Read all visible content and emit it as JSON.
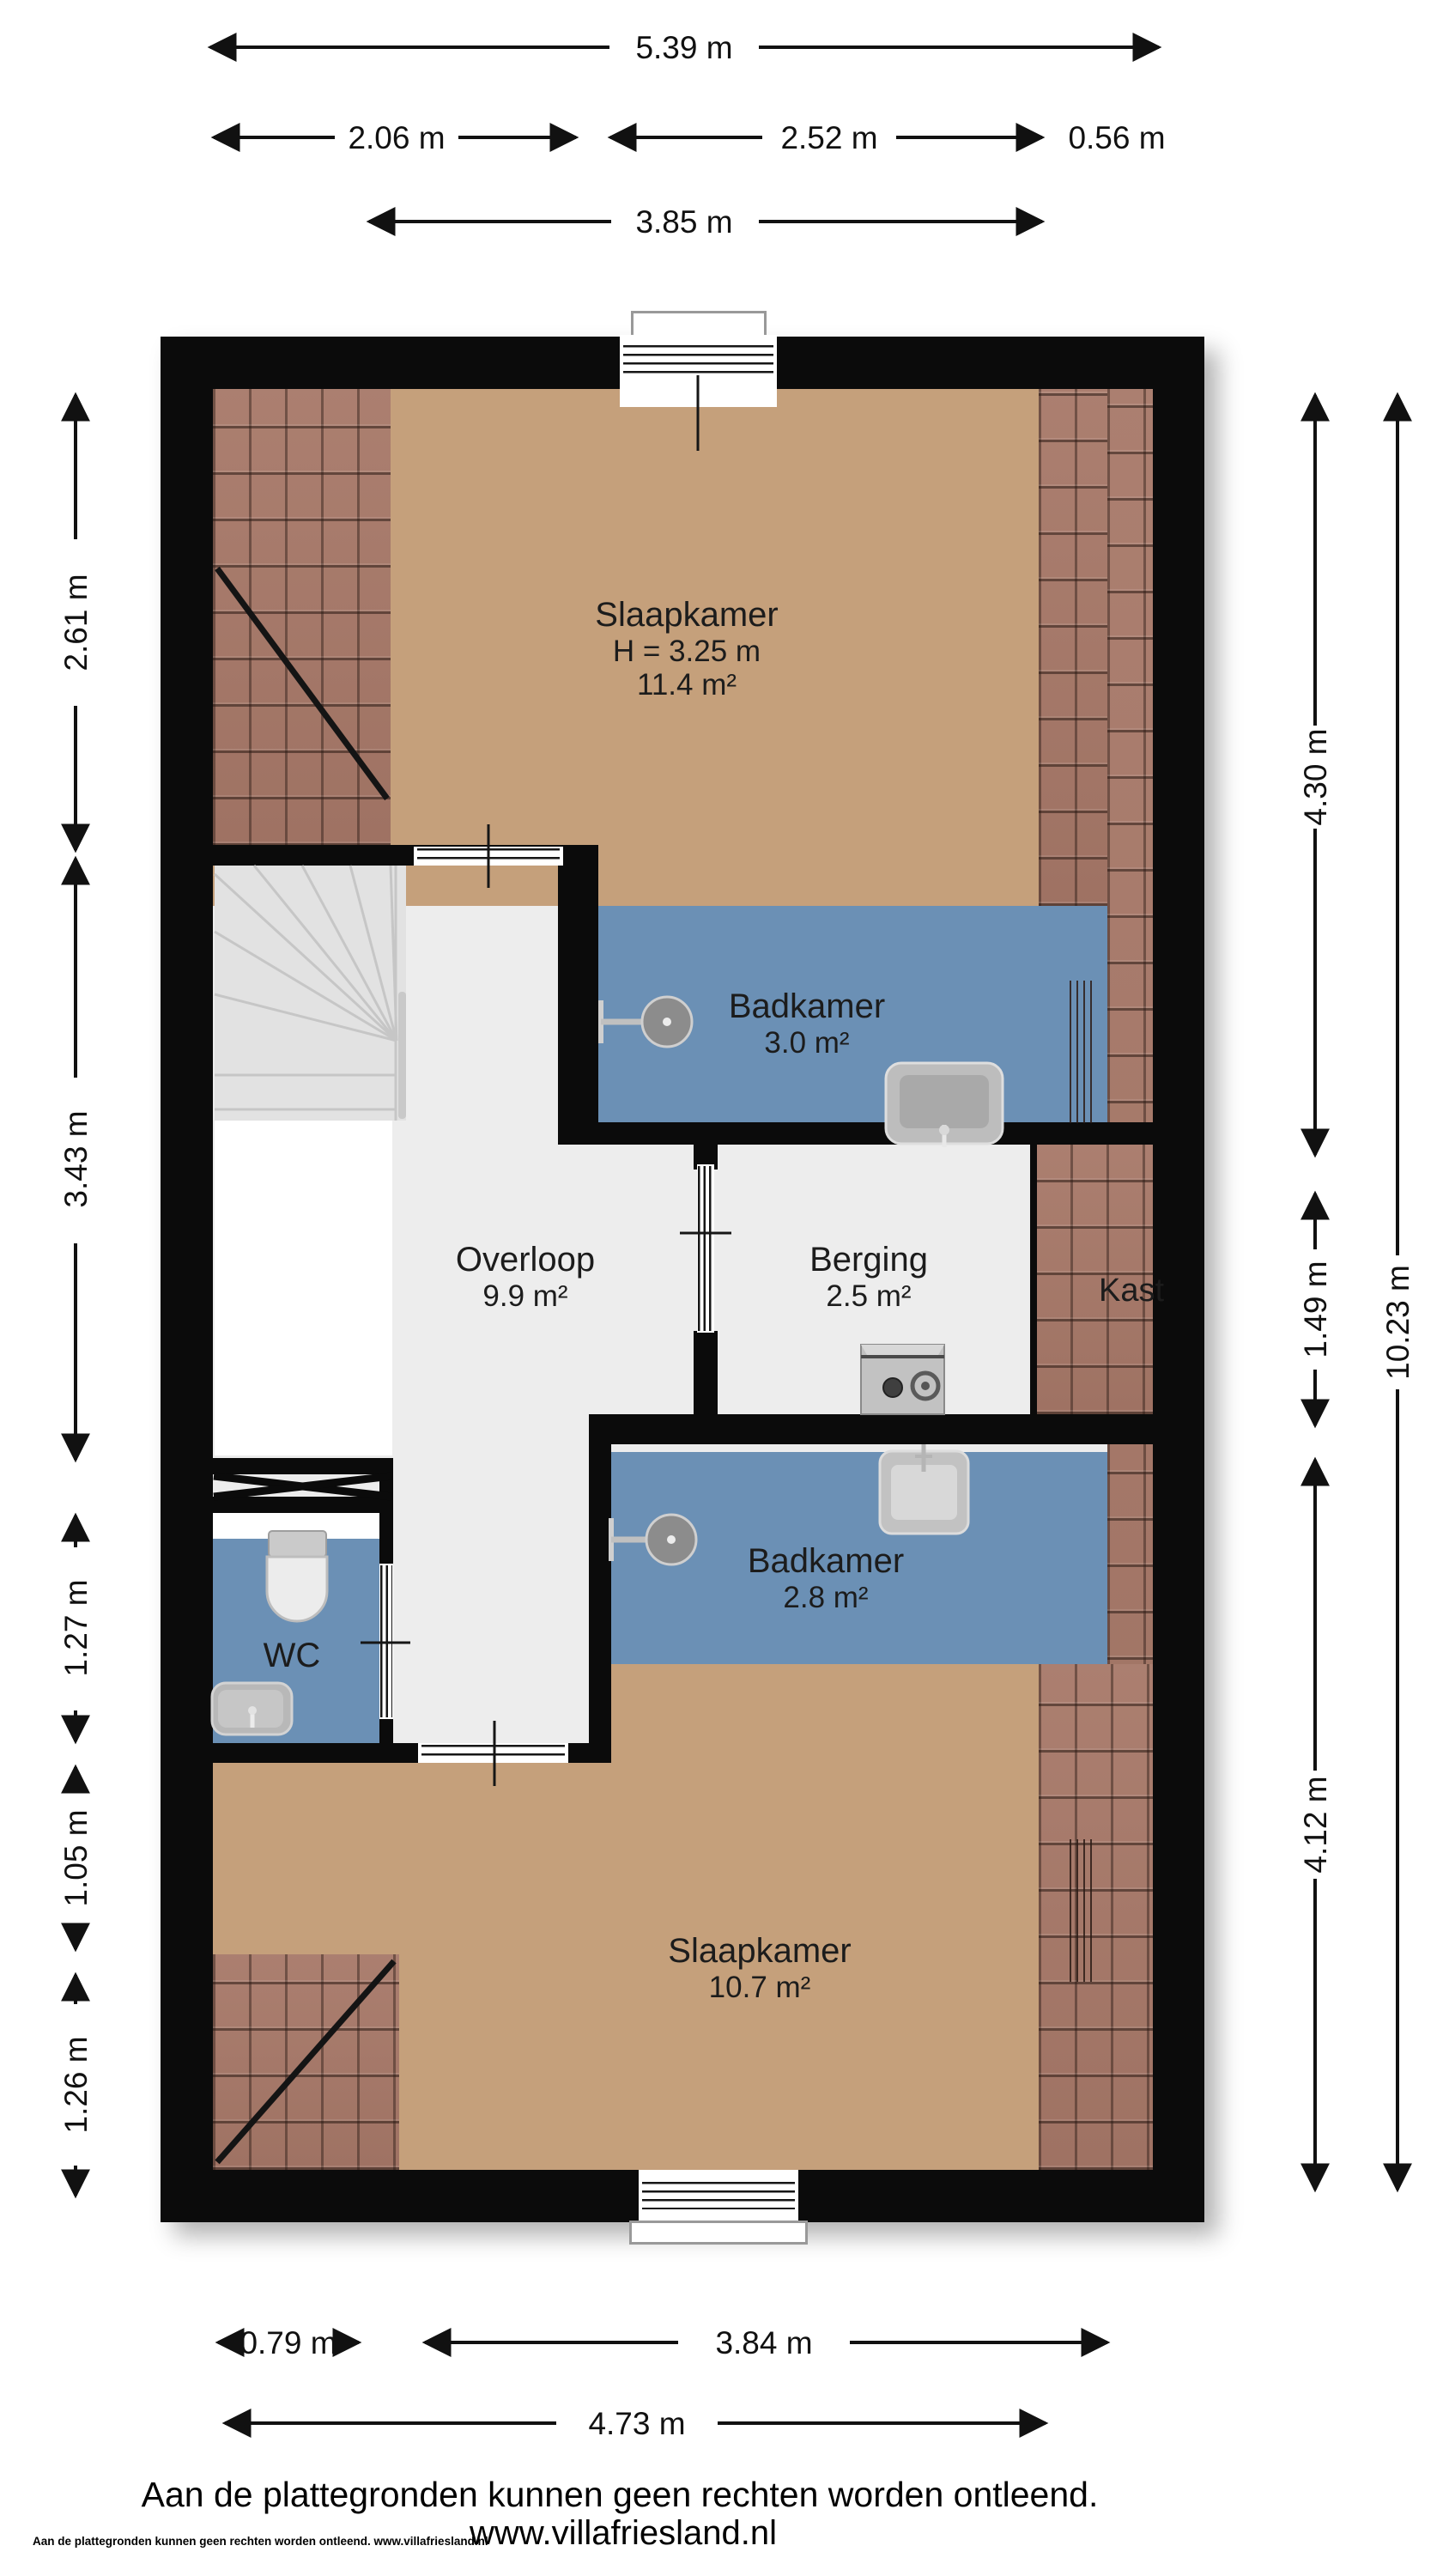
{
  "plan": {
    "rooms": {
      "slaapkamer_boven": {
        "name": "Slaapkamer",
        "height": "H = 3.25 m",
        "area": "11.4 m²"
      },
      "badkamer_boven": {
        "name": "Badkamer",
        "area": "3.0 m²"
      },
      "overloop": {
        "name": "Overloop",
        "area": "9.9 m²"
      },
      "berging": {
        "name": "Berging",
        "area": "2.5 m²"
      },
      "kast": {
        "name": "Kast"
      },
      "badkamer_onder": {
        "name": "Badkamer",
        "area": "2.8 m²"
      },
      "wc": {
        "name": "WC"
      },
      "slaapkamer_onder": {
        "name": "Slaapkamer",
        "area": "10.7 m²"
      }
    },
    "dimensions": {
      "top": {
        "total": "5.39 m",
        "left": "2.06 m",
        "middle": "2.52 m",
        "right": "0.56 m",
        "inner": "3.85 m"
      },
      "left": {
        "d1": "2.61 m",
        "d2": "3.43 m",
        "d3": "1.27 m",
        "d4": "1.05 m",
        "d5": "1.26 m"
      },
      "right": {
        "d1": "4.30 m",
        "d2": "1.49 m",
        "d3": "4.12 m",
        "total": "10.23 m"
      },
      "bottom": {
        "left": "0.79 m",
        "middle": "3.84 m",
        "total": "4.73 m"
      }
    },
    "colors": {
      "wall": "#0b0b0b",
      "floor_bedroom": "#c5a07b",
      "floor_bathroom": "#6b90b5",
      "floor_hall": "#ededed",
      "roof_tiles": "#a77868"
    },
    "fixtures": [
      "shower",
      "sink",
      "toilet",
      "washing-machine",
      "stairs"
    ]
  },
  "footer": {
    "disclaimer": "Aan de plattegronden kunnen geen rechten worden ontleend.",
    "website": "www.villafriesland.nl",
    "fineprint": "Aan de plattegronden kunnen geen rechten worden ontleend. www.villafriesland.nl"
  }
}
